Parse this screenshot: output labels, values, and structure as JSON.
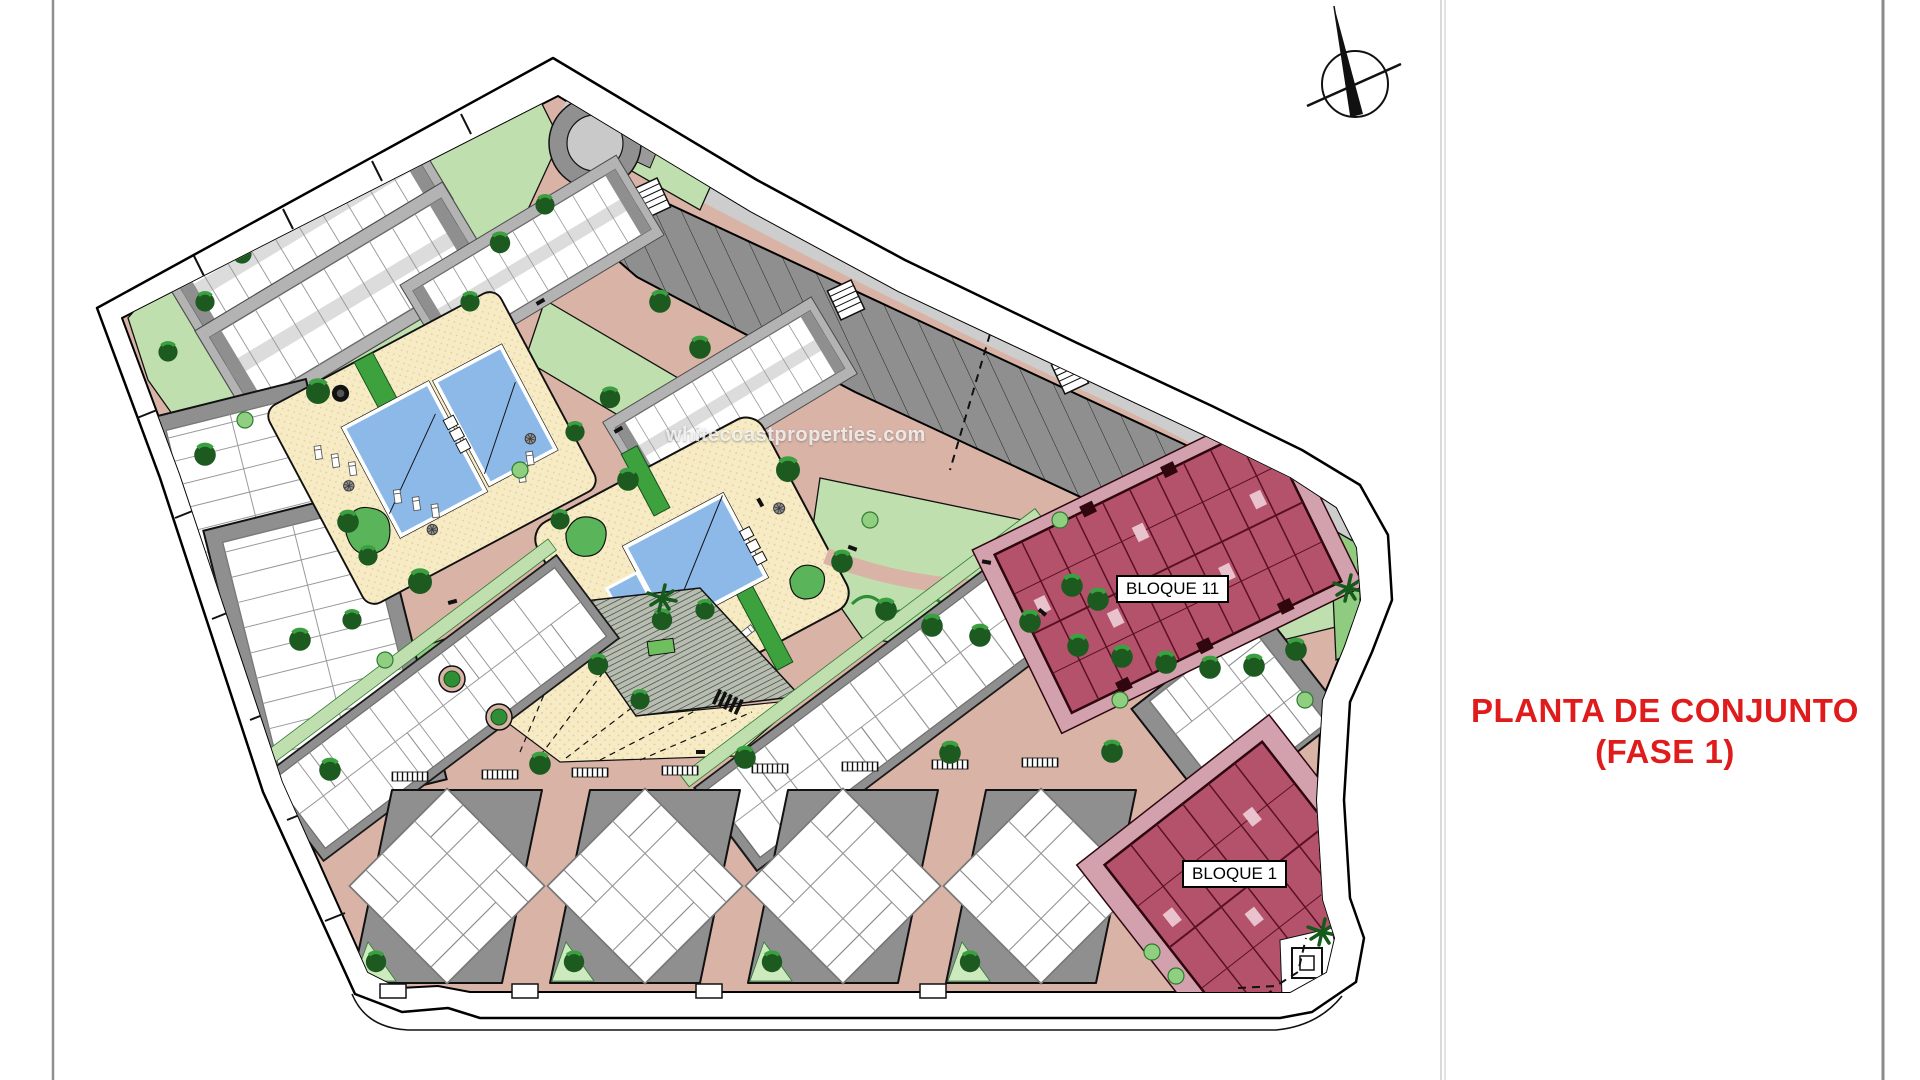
{
  "title_block": {
    "line1": "PLANTA DE CONJUNTO",
    "line2": "(FASE 1)",
    "color": "#e01b1b"
  },
  "plan_labels": {
    "bloque_11": "BLOQUE 11",
    "bloque_1": "BLOQUE 1"
  },
  "watermark": {
    "text": "whitecoastproperties.com"
  },
  "icons": {
    "north_arrow": "north-arrow"
  },
  "palette": {
    "road_salmon": "#d9b3a6",
    "lawn_green": "#bfe0ae",
    "hedge_green": "#8fcc80",
    "path_green": "#3da23d",
    "tree_green": "#1c5a20",
    "parking_gray": "#8f8f8f",
    "road_gray": "#cdcdcd",
    "deck_cream": "#f6ebc4",
    "pool_blue": "#8cb9e8",
    "block_crimson": "#b5526b",
    "block_deck_pink": "#d3a0ae",
    "sheet_line_gray": "#8f8f8f",
    "title_red": "#e01b1b"
  }
}
